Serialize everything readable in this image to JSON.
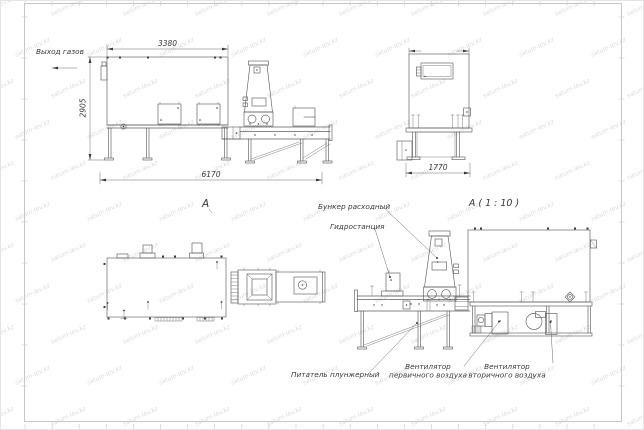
{
  "watermark": {
    "text": "satum-lev.kz",
    "color": "#dadada"
  },
  "colors": {
    "line": "#5e5e5e",
    "text": "#383838",
    "frame": "#c6c6c6",
    "background": "#ffffff"
  },
  "views": {
    "side": {
      "gas_outlet_label": "Выход газов",
      "dim_width_top": "3380",
      "dim_height": "2905",
      "dim_length": "6170",
      "view_marker": "А"
    },
    "front": {
      "dim_width": "1770"
    },
    "detail": {
      "title": "А ( 1 : 10 )",
      "callout_feed_hopper": "Бункер расходный",
      "callout_hydraulic_station": "Гидростанция",
      "callout_plunger_feeder": "Питатель плунжерный",
      "callout_primary_fan_line1": "Вентилятор",
      "callout_primary_fan_line2": "первичного воздуха",
      "callout_secondary_fan_line1": "Вентилятор",
      "callout_secondary_fan_line2": "вторичного воздуха"
    }
  }
}
